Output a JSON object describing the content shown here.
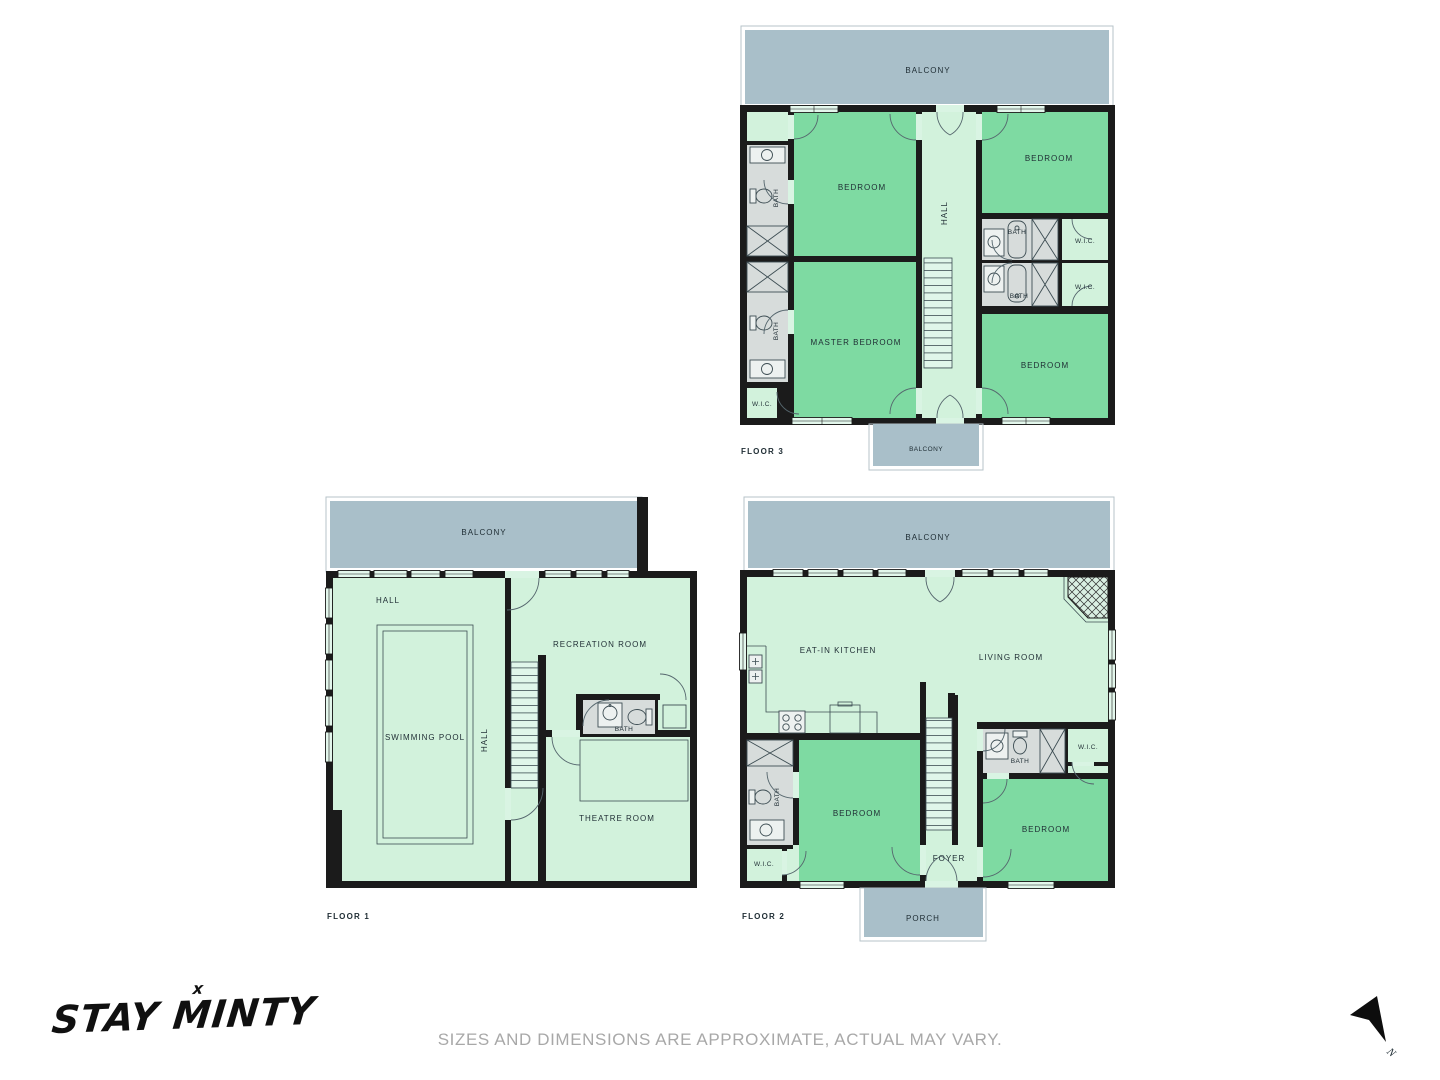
{
  "floors": {
    "floor3": {
      "name": "FLOOR 3",
      "balcony_top": "BALCONY",
      "balcony_bottom": "BALCONY",
      "bedroom_tl": "BEDROOM",
      "bedroom_tr": "BEDROOM",
      "bedroom_br": "BEDROOM",
      "master_bedroom": "MASTER BEDROOM",
      "hall": "HALL",
      "bath_left_upper": "BATH",
      "bath_left_lower": "BATH",
      "bath_right_upper": "BATH",
      "bath_right_lower": "BATH",
      "wic_left": "W.I.C.",
      "wic_right_upper": "W.I.C.",
      "wic_right_lower": "W.I.C."
    },
    "floor1": {
      "name": "FLOOR 1",
      "balcony": "BALCONY",
      "hall": "HALL",
      "hall_vertical": "HALL",
      "swimming_pool": "SWIMMING POOL",
      "recreation_room": "RECREATION ROOM",
      "bath": "BATH",
      "theatre_room": "THEATRE ROOM"
    },
    "floor2": {
      "name": "FLOOR 2",
      "balcony": "BALCONY",
      "eat_in_kitchen": "EAT-IN KITCHEN",
      "living_room": "LIVING ROOM",
      "bedroom_left": "BEDROOM",
      "bedroom_right": "BEDROOM",
      "bath_left": "BATH",
      "bath_right": "BATH",
      "wic_left": "W.I.C.",
      "wic_right": "W.I.C.",
      "foyer": "FOYER",
      "porch": "PORCH"
    }
  },
  "footer": {
    "logo": "STAY MINTY",
    "logo_mark": "x",
    "disclaimer": "SIZES AND DIMENSIONS ARE APPROXIMATE, ACTUAL MAY VARY.",
    "compass": "N"
  },
  "colors": {
    "wall": "#1b1b1b",
    "room_light": "#d2f2dc",
    "room_green": "#7edaa2",
    "bath_gray": "#d7dcdb",
    "balcony_gray": "#a9bfc9"
  }
}
